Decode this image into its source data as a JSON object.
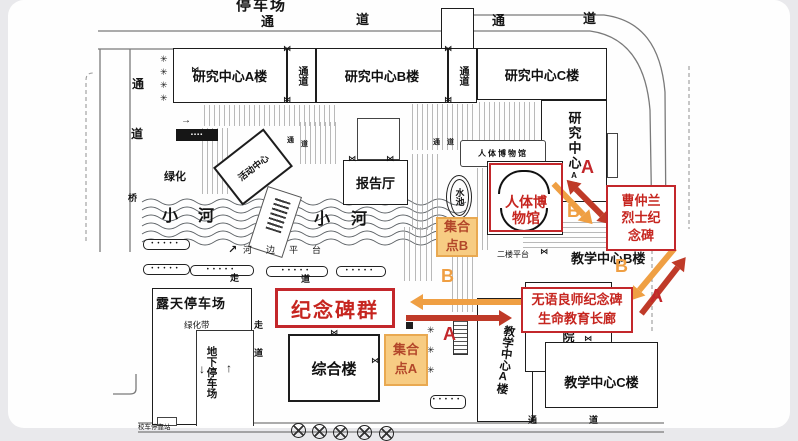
{
  "frame": {
    "top_label": "停车场"
  },
  "roads": {
    "tong": "通",
    "dao": "道",
    "qiao": "桥"
  },
  "river": {
    "xiao": "小",
    "he": "河",
    "riverside": "河边平台"
  },
  "buildings": {
    "research_a": "研究中心A楼",
    "research_b": "研究中心B楼",
    "research_c": "研究中心C楼",
    "research_wing": "研究中心",
    "research_wing_small": "A楼",
    "corridor_tong": "通",
    "corridor_dao": "道",
    "report_hall": "报告厅",
    "activity_center": "活动中心",
    "museum_plain": "人体博物馆",
    "pool": "水池",
    "complex": "综合楼",
    "teaching_a": "教学中心A楼",
    "teaching_b": "教学中心B楼",
    "teaching_c": "教学中心C楼",
    "yuan": "院",
    "platform2": "二楼平台"
  },
  "areas": {
    "greenery": "绿化",
    "green_belt": "绿化带",
    "open_parking": "露天停车场",
    "underground_parking": "地下停车场",
    "walk_zou": "走",
    "walk_dao": "道",
    "bus_stop": "校车停靠站",
    "small_sign": "▪▪▪▪"
  },
  "annotations": {
    "monument_group": "纪念碑群",
    "museum_line1": "人体博",
    "museum_line2": "物馆",
    "cao_line1": "曹仲兰",
    "cao_line2": "烈士纪",
    "cao_line3": "念碑",
    "wuyu_line1": "无语良师纪念碑",
    "wuyu_line2": "生命教育长廊",
    "point_a_line1": "集合",
    "point_a_line2": "点A",
    "point_b_line1": "集合",
    "point_b_line2": "点B",
    "route_a": "A",
    "route_b": "B"
  },
  "glyphs": {
    "up": "↑",
    "down": "↓",
    "ne": "↗",
    "right_small": "→",
    "door": "⋈",
    "tree": "✳",
    "dots": "•••••"
  },
  "colors": {
    "route_a_red": "#c3272b",
    "route_b_orange": "#ef9f43",
    "assembly_fill": "#f7cc83",
    "annotation_red": "#c6251f"
  }
}
